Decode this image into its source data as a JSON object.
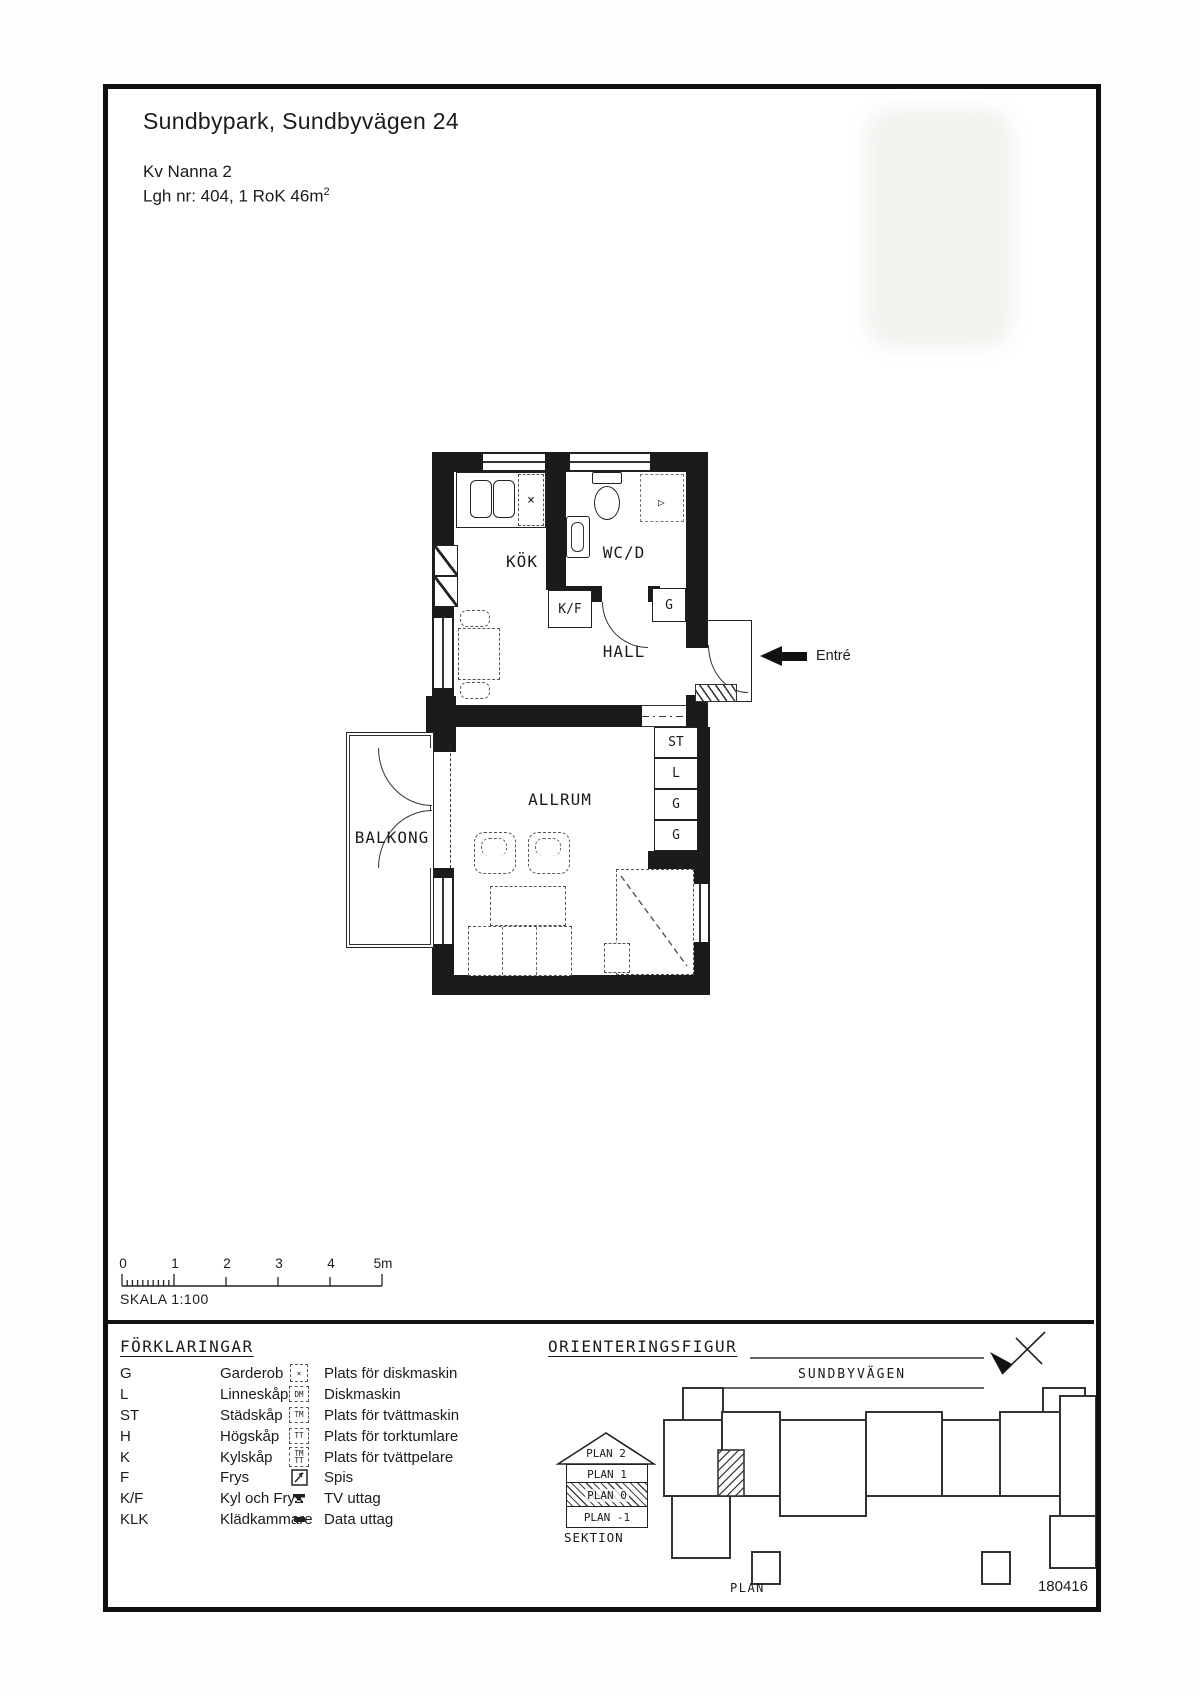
{
  "header": {
    "title": "Sundbypark, Sundbyvägen 24",
    "line2": "Kv Nanna 2",
    "line3": "Lgh nr: 404, 1 RoK 46m",
    "line3_sup": "2"
  },
  "plan": {
    "rooms": {
      "kok": "KÖK",
      "wcd": "WC/D",
      "hall": "HALL",
      "allrum": "ALLRUM",
      "balkong": "BALKONG"
    },
    "closets": {
      "kf": "K/F",
      "hall_g": "G",
      "st": "ST",
      "l": "L",
      "g1": "G",
      "g2": "G"
    },
    "entry_label": "Entré",
    "stove_mark": "×"
  },
  "scalebar": {
    "ticks": [
      "0",
      "1",
      "2",
      "3",
      "4",
      "5m"
    ],
    "label": "SKALA 1:100"
  },
  "legend": {
    "title": "FÖRKLARINGAR",
    "abbreviations": [
      {
        "abbr": "G",
        "label": "Garderob"
      },
      {
        "abbr": "L",
        "label": "Linneskåp"
      },
      {
        "abbr": "ST",
        "label": "Städskåp"
      },
      {
        "abbr": "H",
        "label": "Högskåp"
      },
      {
        "abbr": "K",
        "label": "Kylskåp"
      },
      {
        "abbr": "F",
        "label": "Frys"
      },
      {
        "abbr": "K/F",
        "label": "Kyl och Frys"
      },
      {
        "abbr": "KLK",
        "label": "Klädkammare"
      }
    ],
    "symbols": [
      {
        "text": "×",
        "label": "Plats för diskmaskin"
      },
      {
        "text": "DM",
        "label": "Diskmaskin"
      },
      {
        "text": "TM",
        "label": "Plats för tvättmaskin"
      },
      {
        "text": "TT",
        "label": "Plats för torktumlare"
      },
      {
        "text_top": "TM",
        "text_bottom": "TT",
        "label": "Plats för tvättpelare"
      },
      {
        "label": "Spis"
      },
      {
        "label": "TV uttag"
      },
      {
        "label": "Data uttag"
      }
    ]
  },
  "orientation": {
    "title": "ORIENTERINGSFIGUR",
    "street": "SUNDBYVÄGEN",
    "section_levels": [
      "PLAN 2",
      "PLAN 1",
      "PLAN 0",
      "PLAN -1"
    ],
    "section_label": "SEKTION",
    "plan_label": "PLAN"
  },
  "footer": {
    "date": "180416"
  }
}
